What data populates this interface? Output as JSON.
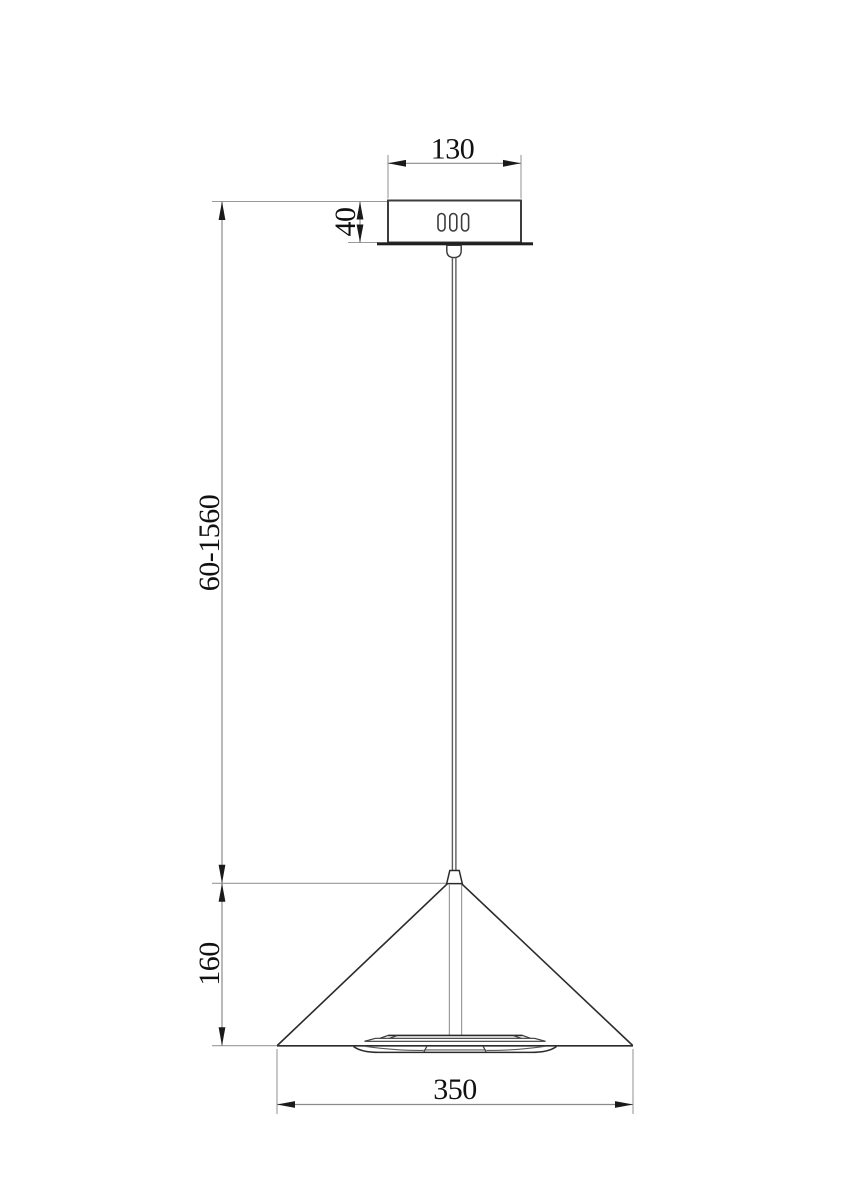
{
  "drawing": {
    "type": "pendant-lamp-dimension-drawing",
    "dimensions": {
      "canopy_width": "130",
      "canopy_height": "40",
      "suspension_length_range": "60-1560",
      "shade_height": "160",
      "shade_diameter": "350"
    },
    "colors": {
      "background": "#ffffff",
      "object_line": "#2b2b2b",
      "dimension_line": "#8b8b8b",
      "text": "#111111"
    }
  }
}
